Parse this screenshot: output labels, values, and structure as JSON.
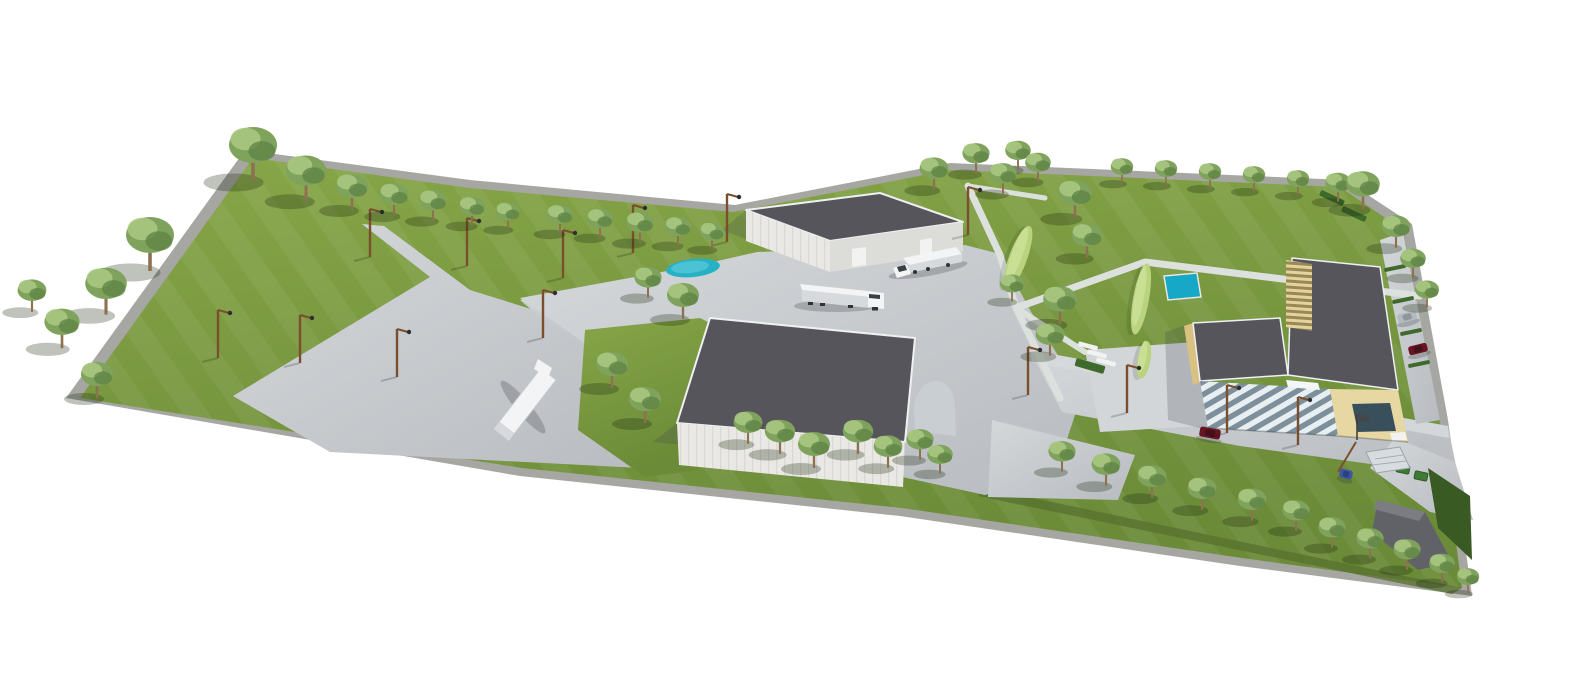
{
  "meta": {
    "type": "architectural-3d-visualization",
    "description": "3D aerial rendering of an industrial campus on a white background: two white warehouses with dark grey roofs, an L-shaped cream office building with a louvered glass facade, a truck yard with two white semi-trailer trucks, a large paved parking apron with a parked trailer, a landscaped park with winding paths, light-green hedge mounds, a pond and a square pool, perimeter tree rows, street light poles, parked cars, green dumpsters and an entrance gate canopy."
  },
  "inventory": {
    "buildings": [
      "warehouse",
      "warehouse",
      "office-building"
    ],
    "trucks": 2,
    "parked_trailer": 1,
    "cars": 4,
    "dumpsters": 2,
    "water_features": [
      "pond",
      "square-pool"
    ]
  },
  "colors": {
    "background": "#ffffff",
    "rim": "#a6a6a2",
    "grass_light": "#87a648",
    "grass_dark": "#6b8b38",
    "grass_stripe": "rgba(255,255,255,0.05)",
    "grass_shadow_band": "#55702d",
    "corner_grass_dark": "#3a5a24",
    "pavement_light": "#d4d8db",
    "pavement_dark": "#b8bcc0",
    "sidewalk": "#d5d9dc",
    "plaza": "#d2d6d9",
    "path": "#dde1de",
    "roof_dark": "#57555c",
    "roof_edge": "#eef0f2",
    "wall_white": "#e9e8e4",
    "wall_white_shade": "#dcdcd9",
    "door_white": "#f2f3f1",
    "annex_gray": "#c9ced2",
    "cream": "#e6d7a3",
    "cream_shade": "#d9c281",
    "window_dark": "#39505c",
    "skylight_white": "#f4f7f8",
    "glass_stripe_light": "#e8eff2",
    "glass_stripe_dark": "#7d8f9a",
    "slat_light": "#e3d49e",
    "slat_dark": "#9a8756",
    "panel_line": "rgba(120,125,130,0.15)",
    "water_pond": "#27b1c6",
    "water_pond_light": "#4cc3d4",
    "water_pool": "#17a7c7",
    "pool_rim": "#e8e8e0",
    "hedge_light": "#b9d37f",
    "hedge_highlight": "#cde29a",
    "hedge_dark": "#3e6b2b",
    "foliage": "#7fa35c",
    "foliage_light": "#a8c77f",
    "foliage_dark": "#5e8244",
    "trunk": "#8d7152",
    "pole": "#7a4f2e",
    "pole_head": "#2e2e2e",
    "truck_white": "#f2f4f5",
    "truck_side": "#d6dadd",
    "windshield": "#3a3f44",
    "wheel_dark": "#2f3338",
    "car_red": "#681522",
    "car_red_top": "#46101a",
    "car_silver": "#b3bac0",
    "car_silver_top": "#8f979d",
    "car_blue": "#3c55a4",
    "car_blue_top": "#2c3f7e",
    "bin_green": "#3e7a33",
    "bin_green_dark": "#2e5c26",
    "bench_white": "#f1f3f2",
    "structure_gray": "#606268",
    "structure_gray_light": "#7b7d82",
    "canopy": "#d6dcdf",
    "canopy_edge": "#9aa4aa",
    "flag_dark": "#44484c",
    "shadow_tree": "rgba(25,40,12,0.28)",
    "shadow_building": "rgba(60,65,75,0.22)",
    "shadow_vehicle": "rgba(50,55,60,0.25)"
  },
  "vegetation": {
    "trees": [
      {
        "x": 253,
        "y": 178,
        "s": 1.5
      },
      {
        "x": 306,
        "y": 198,
        "s": 1.25
      },
      {
        "x": 352,
        "y": 208,
        "s": 1.0
      },
      {
        "x": 394,
        "y": 214,
        "s": 0.9
      },
      {
        "x": 433,
        "y": 219,
        "s": 0.85
      },
      {
        "x": 472,
        "y": 224,
        "s": 0.8
      },
      {
        "x": 508,
        "y": 228,
        "s": 0.75
      },
      {
        "x": 560,
        "y": 232,
        "s": 0.8
      },
      {
        "x": 600,
        "y": 236,
        "s": 0.8
      },
      {
        "x": 640,
        "y": 241,
        "s": 0.85
      },
      {
        "x": 678,
        "y": 244,
        "s": 0.8
      },
      {
        "x": 712,
        "y": 248,
        "s": 0.75
      },
      {
        "x": 150,
        "y": 268,
        "s": 1.5
      },
      {
        "x": 106,
        "y": 312,
        "s": 1.3
      },
      {
        "x": 62,
        "y": 346,
        "s": 1.1
      },
      {
        "x": 97,
        "y": 396,
        "s": 1.0
      },
      {
        "x": 32,
        "y": 310,
        "s": 0.9
      },
      {
        "x": 648,
        "y": 296,
        "s": 0.85
      },
      {
        "x": 683,
        "y": 317,
        "s": 1.0
      },
      {
        "x": 612,
        "y": 386,
        "s": 1.0
      },
      {
        "x": 645,
        "y": 421,
        "s": 1.0
      },
      {
        "x": 934,
        "y": 188,
        "s": 0.9
      },
      {
        "x": 976,
        "y": 172,
        "s": 0.85
      },
      {
        "x": 1018,
        "y": 168,
        "s": 0.8
      },
      {
        "x": 1003,
        "y": 192,
        "s": 0.85
      },
      {
        "x": 1038,
        "y": 180,
        "s": 0.8
      },
      {
        "x": 1075,
        "y": 216,
        "s": 1.05
      },
      {
        "x": 1087,
        "y": 256,
        "s": 0.95
      },
      {
        "x": 1060,
        "y": 322,
        "s": 1.05
      },
      {
        "x": 1050,
        "y": 354,
        "s": 0.9
      },
      {
        "x": 1012,
        "y": 300,
        "s": 0.75
      },
      {
        "x": 1122,
        "y": 182,
        "s": 0.7
      },
      {
        "x": 1166,
        "y": 184,
        "s": 0.7
      },
      {
        "x": 1210,
        "y": 187,
        "s": 0.7
      },
      {
        "x": 1254,
        "y": 190,
        "s": 0.7
      },
      {
        "x": 1298,
        "y": 194,
        "s": 0.7
      },
      {
        "x": 1338,
        "y": 200,
        "s": 0.8
      },
      {
        "x": 1363,
        "y": 207,
        "s": 1.05
      },
      {
        "x": 1396,
        "y": 246,
        "s": 0.9
      },
      {
        "x": 1413,
        "y": 276,
        "s": 0.8
      },
      {
        "x": 1427,
        "y": 306,
        "s": 0.75
      },
      {
        "x": 748,
        "y": 442,
        "s": 0.9
      },
      {
        "x": 780,
        "y": 452,
        "s": 0.95
      },
      {
        "x": 814,
        "y": 466,
        "s": 1.0
      },
      {
        "x": 858,
        "y": 452,
        "s": 0.95
      },
      {
        "x": 888,
        "y": 466,
        "s": 0.9
      },
      {
        "x": 920,
        "y": 458,
        "s": 0.85
      },
      {
        "x": 940,
        "y": 472,
        "s": 0.8
      },
      {
        "x": 1062,
        "y": 470,
        "s": 0.85
      },
      {
        "x": 1106,
        "y": 484,
        "s": 0.9
      },
      {
        "x": 1152,
        "y": 496,
        "s": 0.9
      },
      {
        "x": 1202,
        "y": 508,
        "s": 0.9
      },
      {
        "x": 1252,
        "y": 519,
        "s": 0.9
      },
      {
        "x": 1296,
        "y": 529,
        "s": 0.85
      },
      {
        "x": 1332,
        "y": 546,
        "s": 0.85
      },
      {
        "x": 1370,
        "y": 557,
        "s": 0.85
      },
      {
        "x": 1407,
        "y": 568,
        "s": 0.85
      },
      {
        "x": 1442,
        "y": 581,
        "s": 0.8
      },
      {
        "x": 1468,
        "y": 592,
        "s": 0.7
      }
    ],
    "hedge_mounds": [
      {
        "x": 1018,
        "y": 258,
        "a": 20,
        "rx": 9,
        "ry": 34
      },
      {
        "x": 1141,
        "y": 299,
        "a": 10,
        "rx": 8,
        "ry": 36
      },
      {
        "x": 1144,
        "y": 360,
        "a": 10,
        "rx": 6.5,
        "ry": 19
      }
    ],
    "green_bars": [
      {
        "x": 1395,
        "y": 268,
        "a": -12,
        "l": 22,
        "w": 4,
        "c": "hedge_dark",
        "n": "parking-divider-hedge"
      },
      {
        "x": 1403,
        "y": 300,
        "a": -12,
        "l": 22,
        "w": 4,
        "c": "hedge_dark",
        "n": "parking-divider-hedge"
      },
      {
        "x": 1411,
        "y": 332,
        "a": -12,
        "l": 22,
        "w": 4,
        "c": "hedge_dark",
        "n": "parking-divider-hedge"
      },
      {
        "x": 1419,
        "y": 364,
        "a": -12,
        "l": 22,
        "w": 4,
        "c": "hedge_dark",
        "n": "parking-divider-hedge"
      },
      {
        "x": 1332,
        "y": 198,
        "a": 25,
        "l": 26,
        "w": 6,
        "c": "hedge_dark",
        "n": "hedge-strip"
      },
      {
        "x": 1354,
        "y": 214,
        "a": 25,
        "l": 26,
        "w": 6,
        "c": "hedge_dark",
        "n": "hedge-strip"
      },
      {
        "x": 1090,
        "y": 366,
        "a": 16,
        "l": 30,
        "w": 8,
        "c": "hedge_dark",
        "n": "planter-hedge"
      }
    ],
    "benches": [
      {
        "x": 1088,
        "y": 346,
        "a": 15,
        "l": 20,
        "w": 4.5,
        "c": "bench_white",
        "n": "bench"
      },
      {
        "x": 1097,
        "y": 354,
        "a": 15,
        "l": 20,
        "w": 4.5,
        "c": "bench_white",
        "n": "bench"
      },
      {
        "x": 1106,
        "y": 362,
        "a": 15,
        "l": 20,
        "w": 4.5,
        "c": "bench_white",
        "n": "bench"
      }
    ]
  },
  "fixtures": {
    "light_poles": [
      {
        "x": 370,
        "y": 257
      },
      {
        "x": 467,
        "y": 266
      },
      {
        "x": 563,
        "y": 278
      },
      {
        "x": 218,
        "y": 358
      },
      {
        "x": 300,
        "y": 363
      },
      {
        "x": 397,
        "y": 377
      },
      {
        "x": 543,
        "y": 338
      },
      {
        "x": 633,
        "y": 253
      },
      {
        "x": 727,
        "y": 242
      },
      {
        "x": 968,
        "y": 235
      },
      {
        "x": 1028,
        "y": 395
      },
      {
        "x": 1127,
        "y": 413
      },
      {
        "x": 1227,
        "y": 433
      },
      {
        "x": 1298,
        "y": 445
      }
    ],
    "dumpsters": [
      {
        "x": 1403,
        "y": 469,
        "a": 12,
        "l": 13,
        "w": 8,
        "c": "bin_green",
        "s": "bin_green_dark",
        "n": "dumpster"
      },
      {
        "x": 1421,
        "y": 476,
        "a": 12,
        "l": 13,
        "w": 8,
        "c": "bin_green",
        "s": "bin_green_dark",
        "n": "dumpster"
      }
    ]
  },
  "vehicles": {
    "cars": [
      {
        "x": 1210,
        "y": 433,
        "a": 10,
        "l": 21,
        "w": 10,
        "body": "car_red",
        "top": "car_red_top"
      },
      {
        "x": 1407,
        "y": 317,
        "a": -14,
        "l": 19,
        "w": 9,
        "body": "car_silver",
        "top": "car_silver_top"
      },
      {
        "x": 1418,
        "y": 349,
        "a": -14,
        "l": 19,
        "w": 9,
        "body": "car_red",
        "top": "car_red_top"
      },
      {
        "x": 1346,
        "y": 474,
        "a": 15,
        "l": 13,
        "w": 9,
        "body": "car_blue",
        "top": "car_blue_top"
      }
    ]
  }
}
